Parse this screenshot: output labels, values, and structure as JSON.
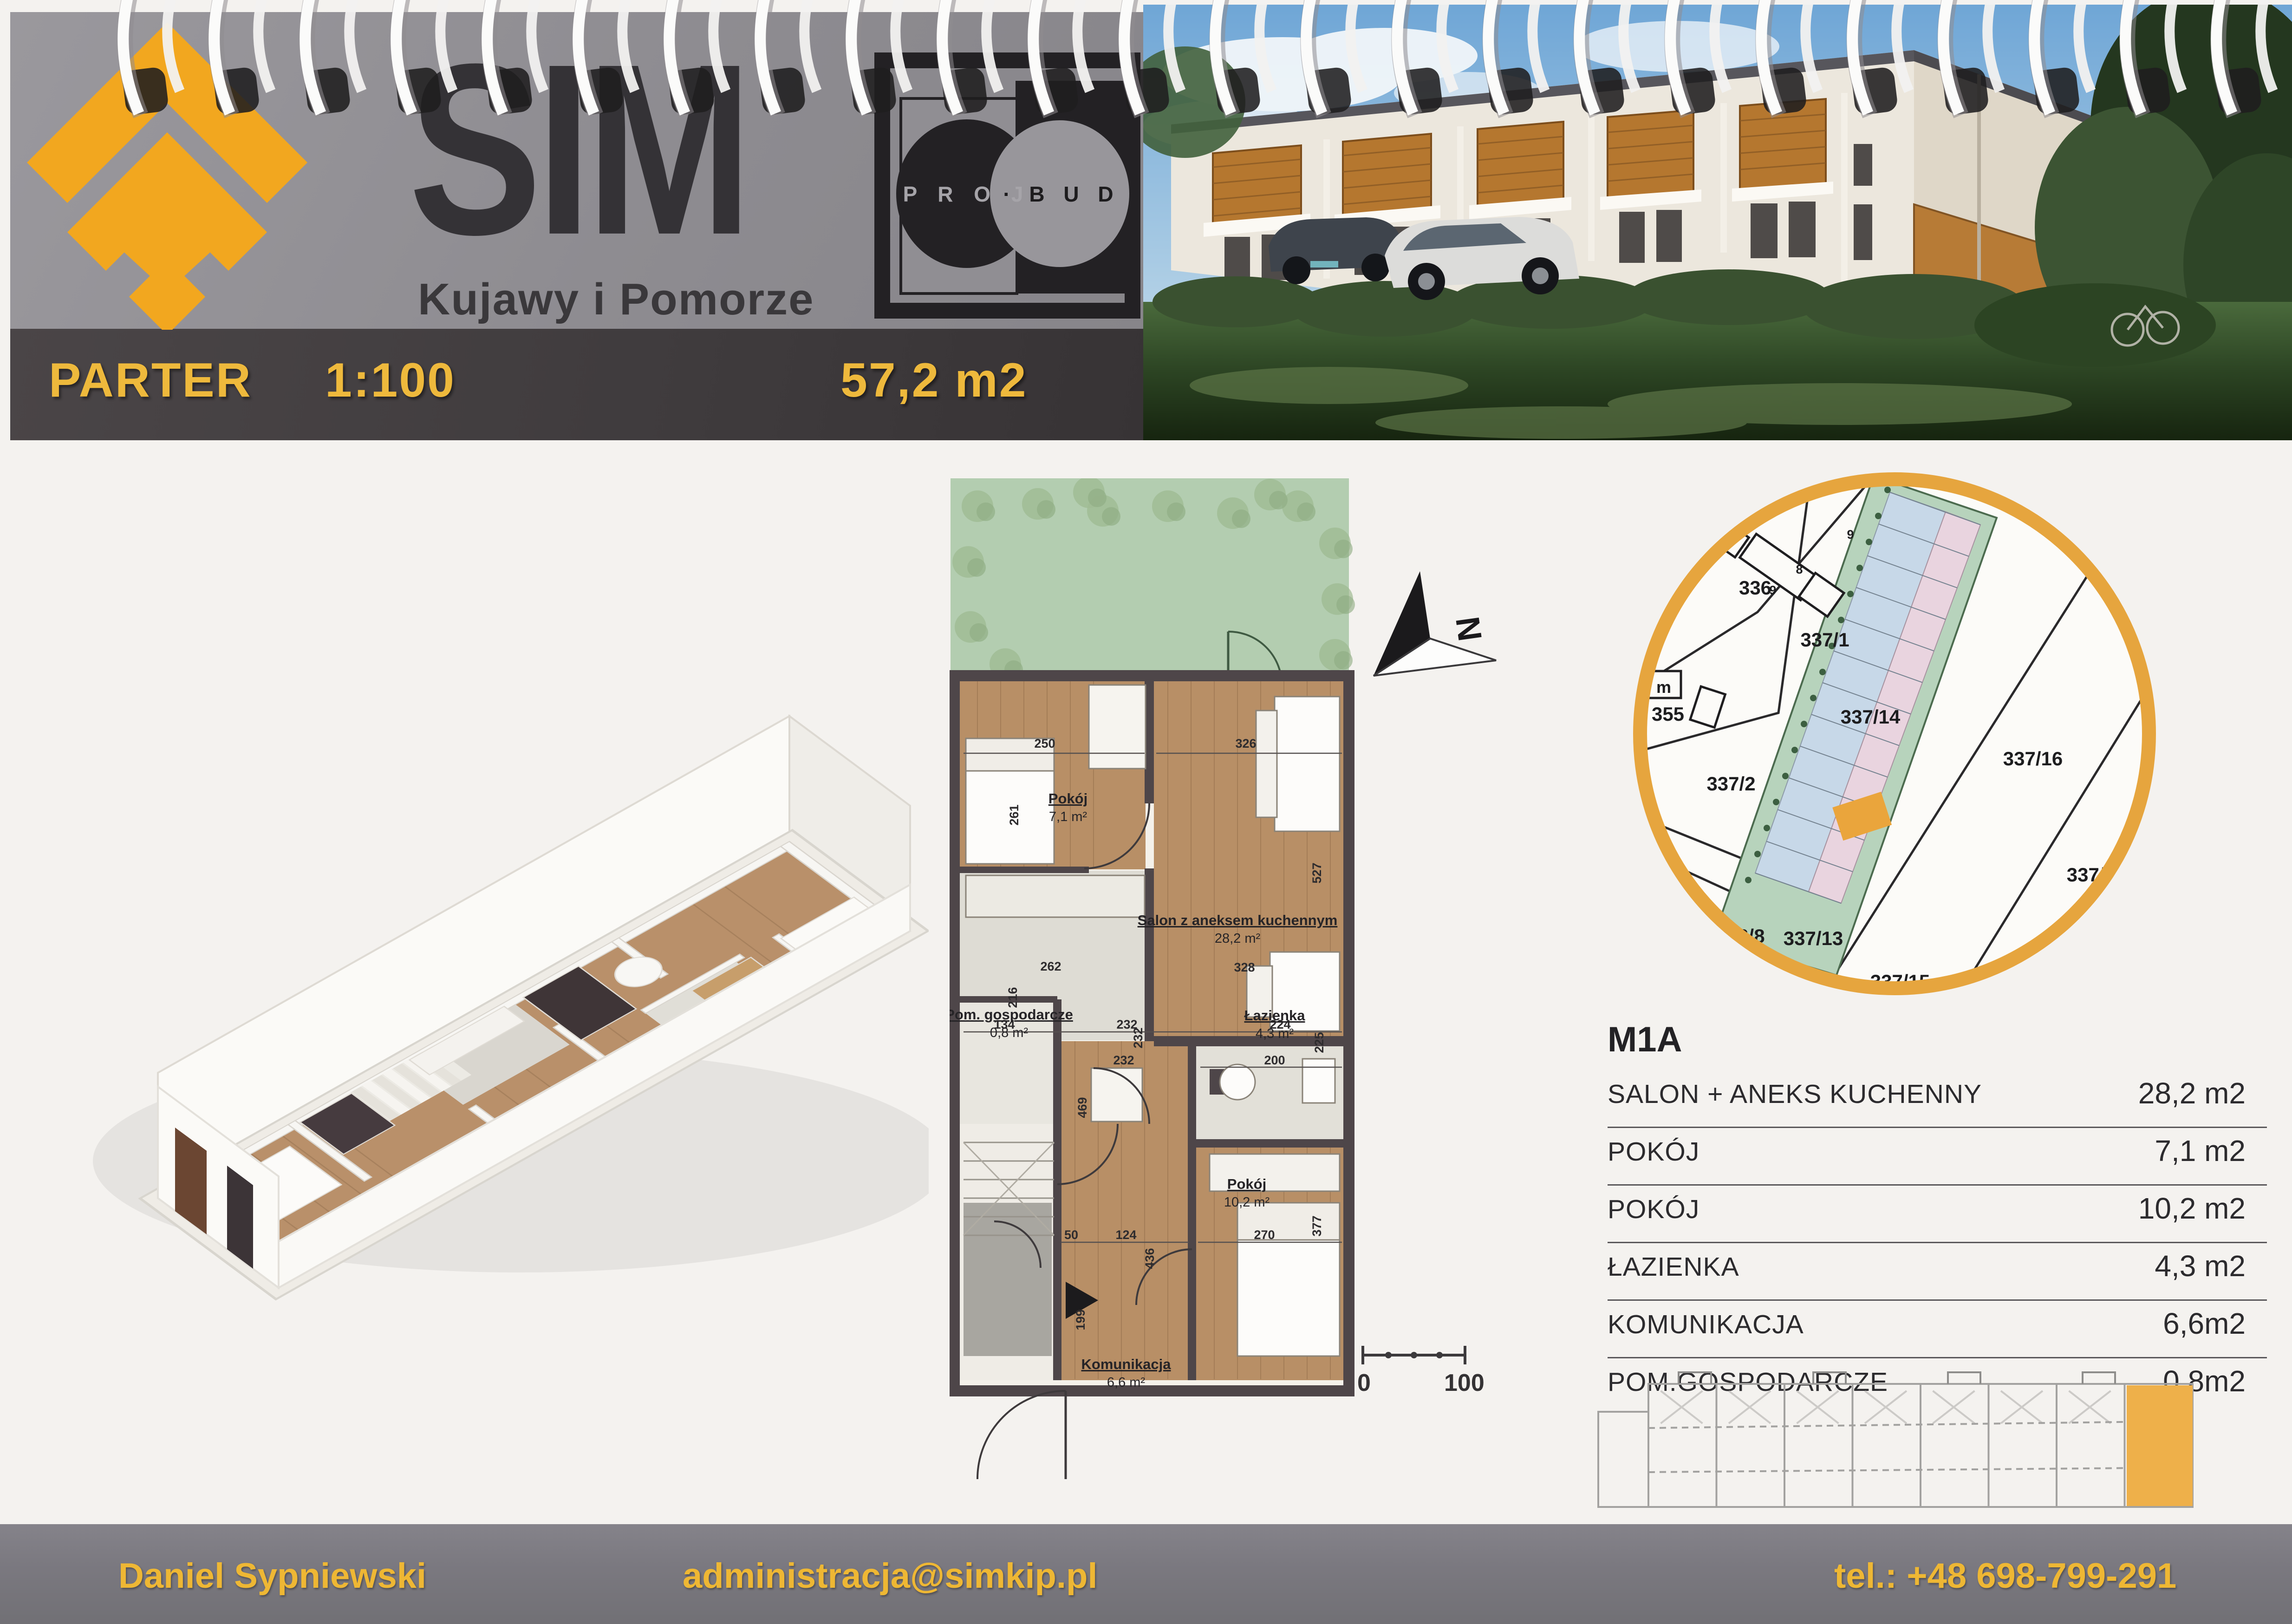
{
  "header": {
    "brand": "SIM",
    "tagline": "Kujawy i Pomorze",
    "projbud": {
      "left": "P R O J",
      "right": "· B U D"
    }
  },
  "titlebar": {
    "floor": "PARTER",
    "scale": "1:100",
    "total_area": "57,2 m2"
  },
  "unit": {
    "id": "M1A",
    "rows": [
      {
        "label": "SALON + ANEKS KUCHENNY",
        "area": "28,2 m2"
      },
      {
        "label": "POKÓJ",
        "area": "7,1 m2"
      },
      {
        "label": "POKÓJ",
        "area": "10,2 m2"
      },
      {
        "label": "ŁAZIENKA",
        "area": "4,3 m2"
      },
      {
        "label": "KOMUNIKACJA",
        "area": "6,6m2"
      },
      {
        "label": "POM.GOSPODARCZE",
        "area": "0,8m2"
      }
    ]
  },
  "plan": {
    "rooms": [
      {
        "name": "Pokój",
        "area": "7,1 m²"
      },
      {
        "name": "Salon z aneksem kuchennym",
        "area": "28,2 m²"
      },
      {
        "name": "Pom. gospodarcze",
        "area": "0,8 m²"
      },
      {
        "name": "Łazienka",
        "area": "4,3 m²"
      },
      {
        "name": "Pokój",
        "area": "10,2 m²"
      },
      {
        "name": "Komunikacja",
        "area": "6,6 m²"
      }
    ],
    "dims": [
      "250",
      "261",
      "326",
      "527",
      "262",
      "216",
      "134",
      "232",
      "328",
      "224",
      "232",
      "232",
      "469",
      "50",
      "124",
      "436",
      "199",
      "200",
      "225",
      "270",
      "377"
    ],
    "compass": "N"
  },
  "sitemap": {
    "parcels": [
      "336",
      "337/1",
      "337/14",
      "337/16",
      "337/18",
      "337/2",
      "355",
      "566/8",
      "337/13",
      "337/15"
    ],
    "small_labels": [
      "9",
      "8",
      "9"
    ],
    "meter_box": "m"
  },
  "scalebar": {
    "start": "0",
    "end": "100"
  },
  "footer": {
    "name": "Daniel Sypniewski",
    "email": "administracja@simkip.pl",
    "phone": "tel.: +48 698-799-291"
  },
  "colors": {
    "accent_yellow": "#eeb93c",
    "logo_orange": "#f2a71f",
    "band_gray": "#8e8c91",
    "band_dark": "#3f3b3d",
    "footer_gray": "#7b7980",
    "paper": "#f4f2ef",
    "wood_floor": "#b9906a",
    "wall_dark": "#4e4649",
    "garden_green": "#b3cdb0",
    "map_ring_orange": "#e6a53e",
    "map_green": "#b7d3bc",
    "map_blue": "#c7d8e8",
    "map_pink": "#e9d4df"
  }
}
